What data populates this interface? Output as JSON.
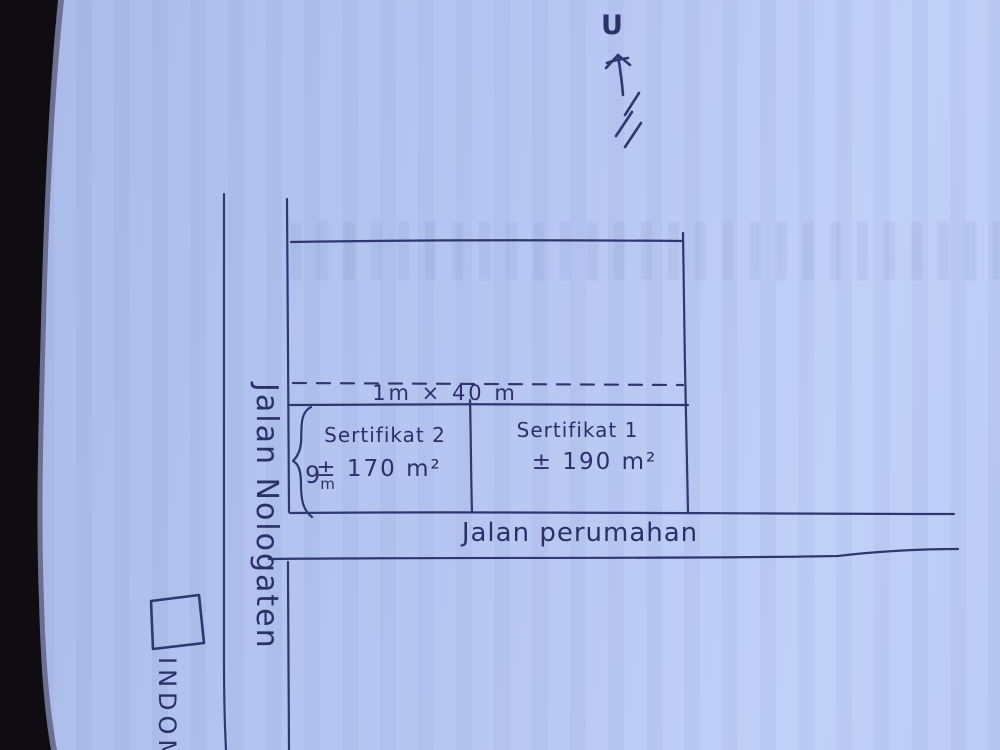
{
  "compass": {
    "label": "U"
  },
  "roads": {
    "vertical_label": "Jalan Nologaten",
    "horizontal_label": "Jalan perumahan"
  },
  "strip": {
    "label": "1m × 40 m"
  },
  "plots": {
    "left": {
      "name": "Sertifikat 2",
      "area": "± 170 m²",
      "depth_value": "9",
      "depth_unit": "m"
    },
    "right": {
      "name": "Sertifikat 1",
      "area": "± 190 m²"
    }
  },
  "landmark": {
    "label": "INDOM"
  },
  "colors": {
    "paper": "#b6c5f1",
    "ink": "#2e3870",
    "handwriting": "#2a3168",
    "photo_edge": "#0f0c12"
  }
}
